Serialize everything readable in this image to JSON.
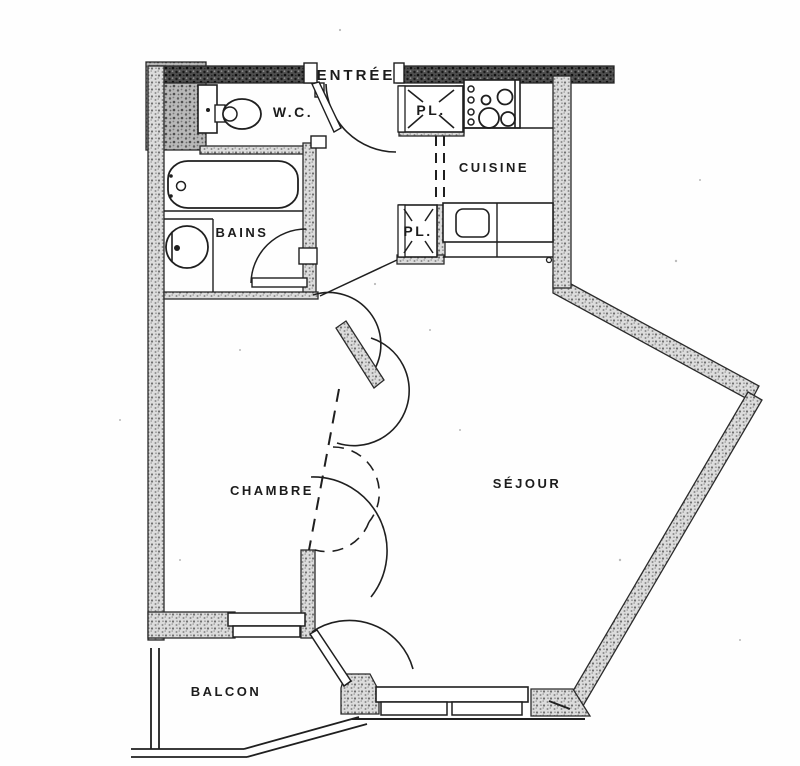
{
  "plan": {
    "type": "apartment-floor-plan",
    "rooms": {
      "entree": {
        "label": "ENTRÉE"
      },
      "wc": {
        "label": "W.C."
      },
      "cuisine": {
        "label": "CUISINE"
      },
      "bains": {
        "label": "BAINS"
      },
      "placard1": {
        "label": "PL."
      },
      "placard2": {
        "label": "PL."
      },
      "chambre": {
        "label": "CHAMBRE"
      },
      "sejour": {
        "label": "SÉJOUR"
      },
      "balcon": {
        "label": "BALCON"
      }
    },
    "fixtures": [
      "toilet",
      "bathtub",
      "washbasin",
      "stove-burners",
      "kitchen-sink",
      "closet-cross-1",
      "closet-cross-2"
    ],
    "colors": {
      "ink": "#1f1f1f",
      "paper": "#fefefe",
      "wall_light": "#dcdcdc",
      "wall_dark": "#4a4a4a",
      "wall_medium": "#b8b8b8"
    }
  }
}
